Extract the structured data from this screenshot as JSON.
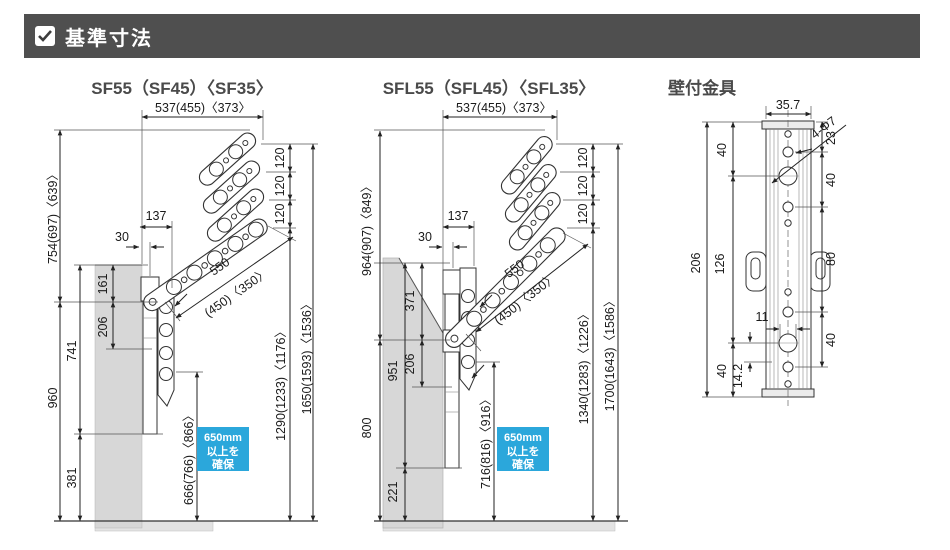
{
  "header": {
    "title": "基準寸法"
  },
  "colors": {
    "accent_blue": "#2ba7db",
    "header_gray": "#4f4f4f"
  },
  "sf": {
    "title": "SF55（SF45）〈SF35〉",
    "dim_reach": "537(455)〈373〉",
    "dim_arm_top": "754(697)〈639〉",
    "dim_wall_height": "960",
    "dim_bracket_top": "741",
    "dim_bracket_bottom": "381",
    "dim_mount_upper": "161",
    "dim_mount_lower": "206",
    "dim_arm_inset": "137",
    "dim_wall_clear": "30",
    "dim_arm_len": "550",
    "dim_arm_len_alt": "(450)〈350〉",
    "dim_pitch": [
      "120",
      "120",
      "120"
    ],
    "dim_pole_clear": "666(766)〈866〉",
    "dim_tip_height": "1290(1233)〈1176〉",
    "dim_max_height": "1650(1593)〈1536〉",
    "note": {
      "l1": "650mm",
      "l2": "以上を",
      "l3": "確保"
    }
  },
  "sfl": {
    "title": "SFL55（SFL45）〈SFL35〉",
    "dim_reach": "537(455)〈373〉",
    "dim_arm_top": "964(907)〈849〉",
    "dim_wall_height": "800",
    "dim_bracket_top": "951",
    "dim_bracket_bottom": "221",
    "dim_mount_upper": "371",
    "dim_mount_lower": "206",
    "dim_arm_inset": "137",
    "dim_wall_clear": "30",
    "dim_arm_len": "550",
    "dim_arm_len_alt": "(450)〈350〉",
    "dim_pitch": [
      "120",
      "120",
      "120"
    ],
    "dim_pole_clear": "716(816)〈916〉",
    "dim_tip_height": "1340(1283)〈1226〉",
    "dim_max_height": "1700(1643)〈1586〉",
    "note": {
      "l1": "650mm",
      "l2": "以上を",
      "l3": "確保"
    }
  },
  "bracket": {
    "title": "壁付金具",
    "dim_width": "35.7",
    "dim_total_height": "206",
    "dim_top_to_hole": "40",
    "dim_hole_span": "126",
    "dim_hole_to_bottom": "40",
    "dim_top_edge": "23",
    "dim_pitch_top": "40",
    "dim_pitch_mid": "80",
    "dim_pitch_bottom": "40",
    "dim_slot_width": "11",
    "dim_foot": "14.2",
    "label_holes": "4-Φ7"
  }
}
